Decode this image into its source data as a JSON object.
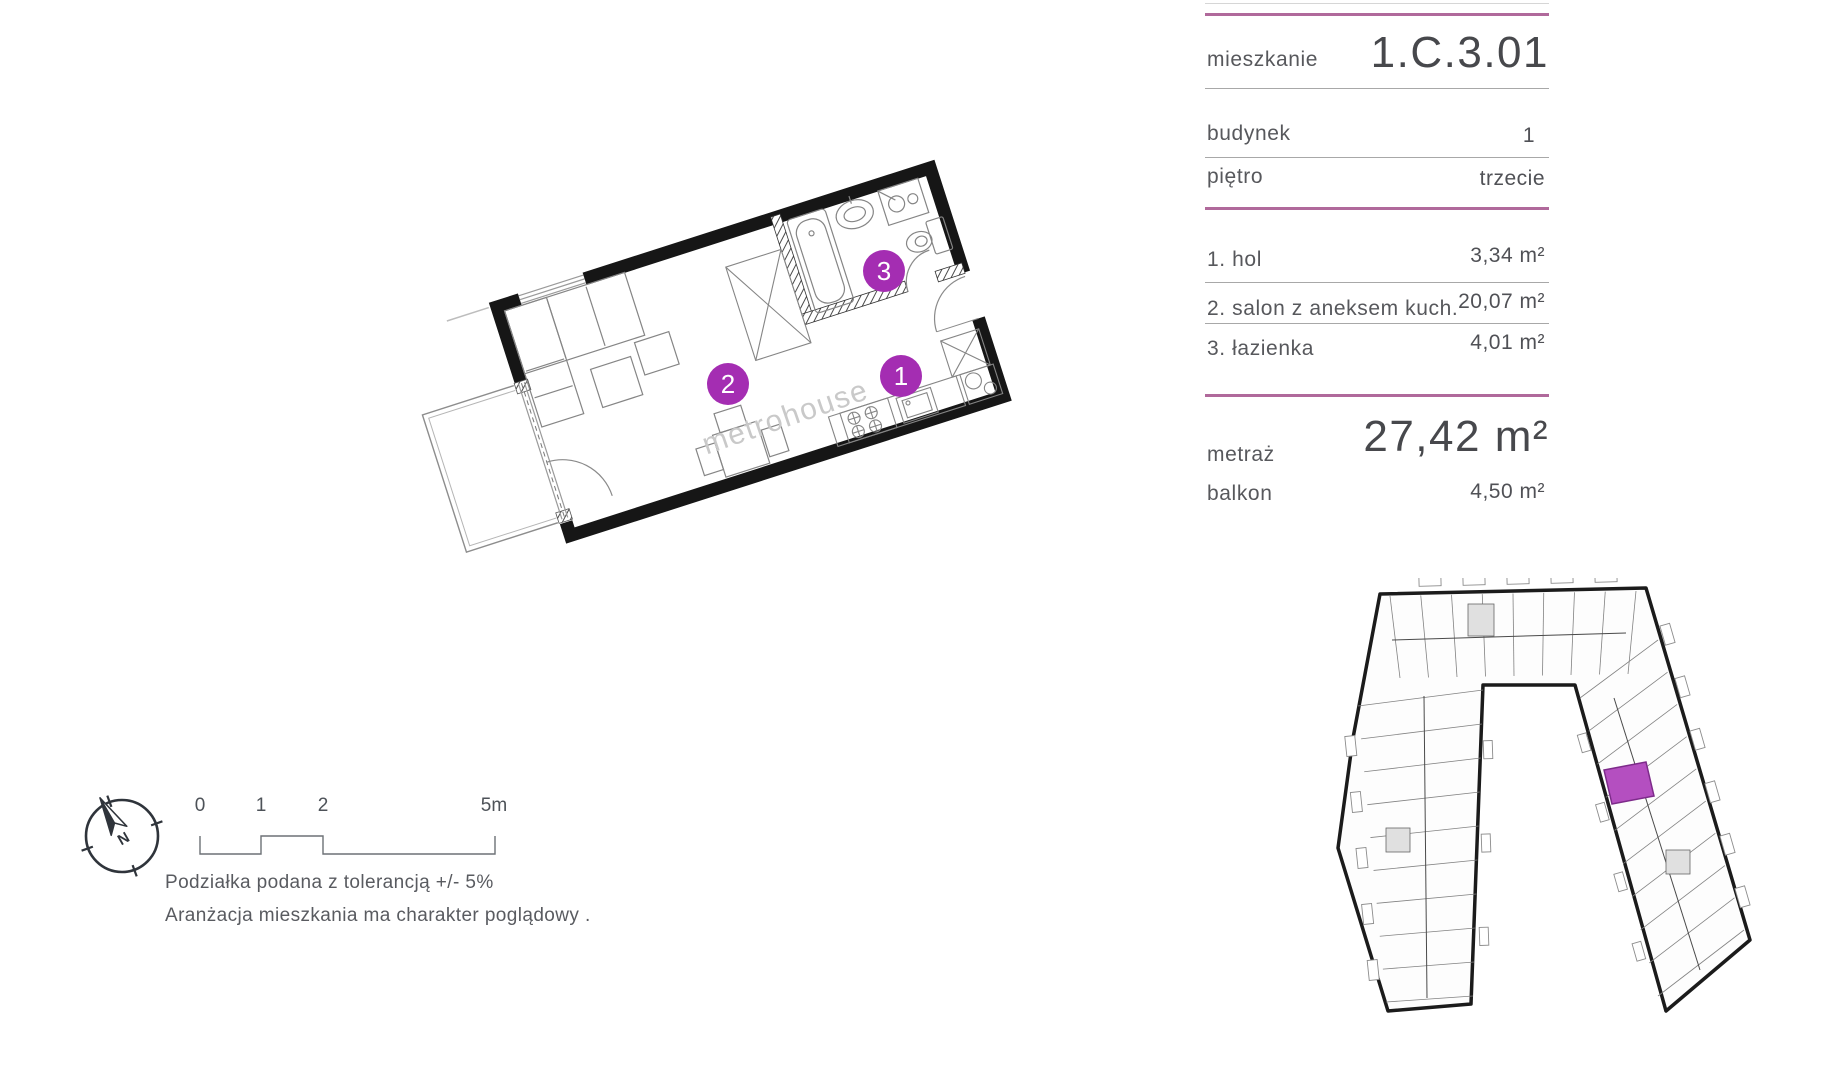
{
  "colors": {
    "accent_purple": "#a42db2",
    "divider_pink": "#b0699b",
    "unit_highlight": "#b44fc0",
    "wall_black": "#161616"
  },
  "panel": {
    "apartment_label": "mieszkanie",
    "apartment_value": "1.C.3.01",
    "building_label": "budynek",
    "building_value": "1",
    "floor_label": "piętro",
    "floor_value": "trzecie",
    "rooms": [
      {
        "name": "1. hol",
        "area": "3,34 m²"
      },
      {
        "name": "2. salon z aneksem kuch.",
        "area": "20,07 m²"
      },
      {
        "name": "3. łazienka",
        "area": "4,01 m²"
      }
    ],
    "total_label": "metraż",
    "total_value": "27,42 m²",
    "balcony_label": "balkon",
    "balcony_value": "4,50 m²"
  },
  "floorplan": {
    "markers": [
      {
        "number": "1"
      },
      {
        "number": "2"
      },
      {
        "number": "3"
      }
    ],
    "watermark": "metrohouse"
  },
  "legend": {
    "compass_label": "N",
    "scale_ticks": [
      "0",
      "1",
      "2",
      "5m"
    ],
    "note_1": "Podziałka podana z tolerancją +/- 5%",
    "note_2": "Aranżacja mieszkania ma charakter poglądowy ."
  }
}
